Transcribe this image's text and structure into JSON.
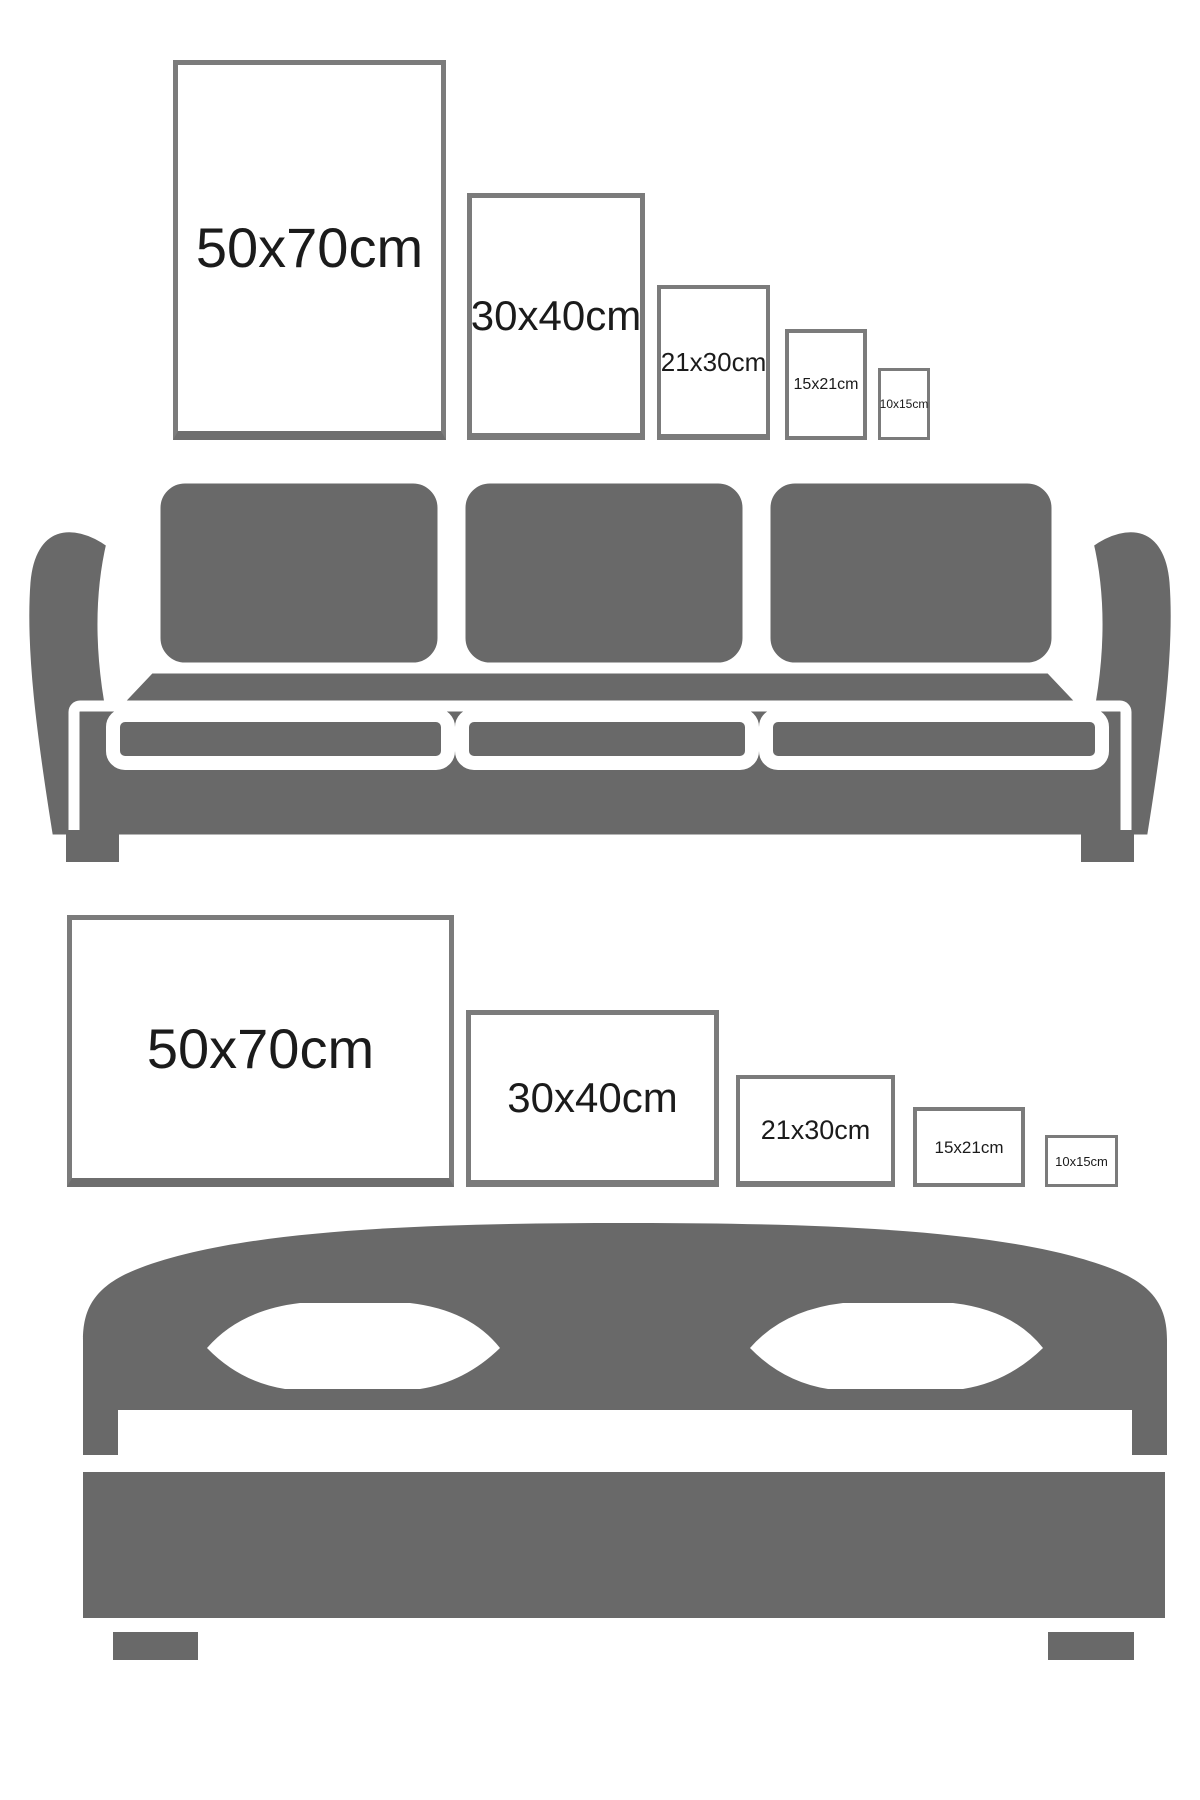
{
  "colors": {
    "furniture_gray": "#696969",
    "frame_border": "#7b7b7b",
    "frame_border_shadow": "#6e6e6e",
    "label_text": "#1b1b1b",
    "background": "#ffffff"
  },
  "sections": [
    {
      "location": "wall-above-sofa",
      "furniture": "sofa-icon",
      "frame_orientation": "portrait",
      "frames": [
        {
          "size_label": "50x70cm"
        },
        {
          "size_label": "30x40cm"
        },
        {
          "size_label": "21x30cm"
        },
        {
          "size_label": "15x21cm"
        },
        {
          "size_label": "10x15cm"
        }
      ]
    },
    {
      "location": "wall-above-bed",
      "furniture": "bed-icon",
      "frame_orientation": "landscape",
      "frames": [
        {
          "size_label": "50x70cm"
        },
        {
          "size_label": "30x40cm"
        },
        {
          "size_label": "21x30cm"
        },
        {
          "size_label": "15x21cm"
        },
        {
          "size_label": "10x15cm"
        }
      ]
    }
  ]
}
